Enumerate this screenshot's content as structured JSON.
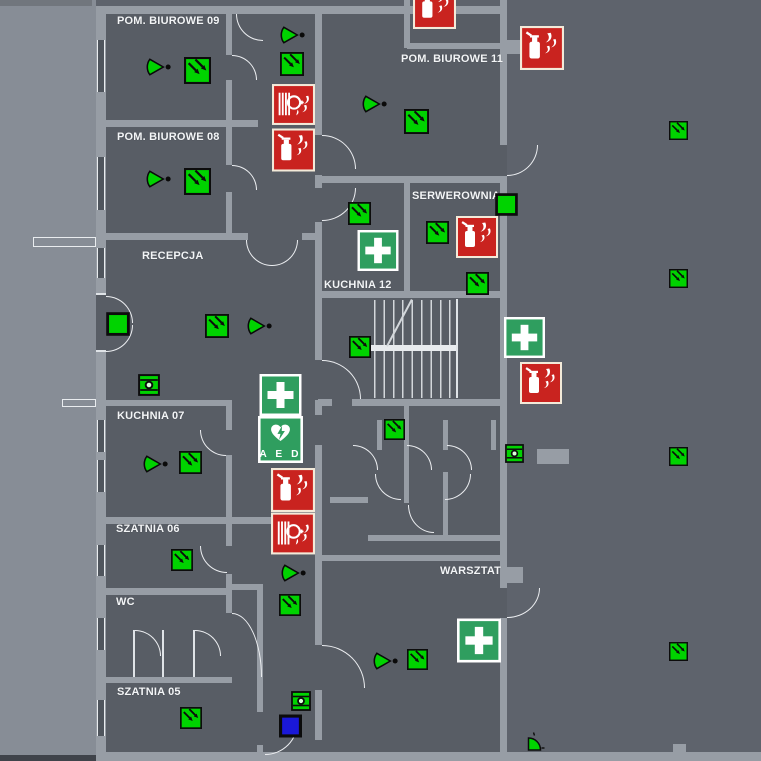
{
  "rooms": [
    {
      "label": "POM. BIUROWE 09"
    },
    {
      "label": "POM. BIUROWE 08"
    },
    {
      "label": "POM. BIUROWE 11"
    },
    {
      "label": "SERWEROWNIA"
    },
    {
      "label": "RECEPCJA"
    },
    {
      "label": "KUCHNIA 12"
    },
    {
      "label": "KUCHNIA 07"
    },
    {
      "label": "SZATNIA 06"
    },
    {
      "label": "WC"
    },
    {
      "label": "SZATNIA 05"
    },
    {
      "label": "WARSZTAT"
    }
  ],
  "aed_label": "A E D",
  "colors": {
    "evacuation_green": "#00D300",
    "sign_green": "#2F9E5F",
    "fire_red": "#C9231F",
    "sign_cream": "#F3EAD9",
    "equipment_blue": "#1A18D8",
    "background": "#5E636C",
    "wall": "#979DA5"
  },
  "icons": [
    {
      "t": "arrow",
      "x": 184,
      "y": 57,
      "w": 27,
      "h": 27
    },
    {
      "t": "arrow",
      "x": 184,
      "y": 168,
      "w": 27,
      "h": 27
    },
    {
      "t": "arrow",
      "x": 280,
      "y": 52,
      "w": 24,
      "h": 24
    },
    {
      "t": "arrow",
      "x": 404,
      "y": 109,
      "w": 25,
      "h": 25
    },
    {
      "t": "arrow",
      "x": 348,
      "y": 202,
      "w": 23,
      "h": 23
    },
    {
      "t": "arrow",
      "x": 426,
      "y": 221,
      "w": 23,
      "h": 23
    },
    {
      "t": "arrow",
      "x": 466,
      "y": 272,
      "w": 23,
      "h": 23
    },
    {
      "t": "arrow",
      "x": 205,
      "y": 314,
      "w": 24,
      "h": 24
    },
    {
      "t": "arrow",
      "x": 349,
      "y": 336,
      "w": 22,
      "h": 22
    },
    {
      "t": "arrow",
      "x": 179,
      "y": 451,
      "w": 23,
      "h": 23
    },
    {
      "t": "arrow",
      "x": 384,
      "y": 419,
      "w": 21,
      "h": 21
    },
    {
      "t": "arrow",
      "x": 171,
      "y": 549,
      "w": 22,
      "h": 22
    },
    {
      "t": "arrow",
      "x": 279,
      "y": 594,
      "w": 22,
      "h": 22
    },
    {
      "t": "arrow",
      "x": 180,
      "y": 707,
      "w": 22,
      "h": 22
    },
    {
      "t": "arrow",
      "x": 407,
      "y": 649,
      "w": 21,
      "h": 21
    },
    {
      "t": "arrow",
      "x": 669,
      "y": 121,
      "w": 19,
      "h": 19
    },
    {
      "t": "arrow",
      "x": 669,
      "y": 269,
      "w": 19,
      "h": 19
    },
    {
      "t": "arrow",
      "x": 669,
      "y": 447,
      "w": 19,
      "h": 19
    },
    {
      "t": "arrow",
      "x": 669,
      "y": 642,
      "w": 19,
      "h": 19
    },
    {
      "t": "cone",
      "x": 145,
      "y": 55,
      "w": 27,
      "h": 24
    },
    {
      "t": "cone",
      "x": 145,
      "y": 167,
      "w": 27,
      "h": 24
    },
    {
      "t": "cone",
      "x": 279,
      "y": 23,
      "w": 27,
      "h": 24
    },
    {
      "t": "cone",
      "x": 361,
      "y": 92,
      "w": 27,
      "h": 24
    },
    {
      "t": "cone",
      "x": 246,
      "y": 314,
      "w": 27,
      "h": 24
    },
    {
      "t": "cone",
      "x": 142,
      "y": 452,
      "w": 27,
      "h": 24
    },
    {
      "t": "cone",
      "x": 280,
      "y": 561,
      "w": 27,
      "h": 24
    },
    {
      "t": "cone",
      "x": 372,
      "y": 649,
      "w": 27,
      "h": 24
    },
    {
      "t": "firstaid",
      "x": 357,
      "y": 230,
      "w": 42,
      "h": 41
    },
    {
      "t": "firstaid",
      "x": 504,
      "y": 317,
      "w": 41,
      "h": 41
    },
    {
      "t": "firstaid",
      "x": 258,
      "y": 374,
      "w": 45,
      "h": 42
    },
    {
      "t": "firstaid",
      "x": 457,
      "y": 618,
      "w": 44,
      "h": 45
    },
    {
      "t": "aed",
      "x": 258,
      "y": 416,
      "w": 45,
      "h": 47
    },
    {
      "t": "ext",
      "x": 413,
      "y": -14,
      "w": 43,
      "h": 43
    },
    {
      "t": "ext",
      "x": 520,
      "y": 26,
      "w": 44,
      "h": 44
    },
    {
      "t": "ext",
      "x": 272,
      "y": 128,
      "w": 43,
      "h": 44
    },
    {
      "t": "ext",
      "x": 456,
      "y": 215,
      "w": 42,
      "h": 44
    },
    {
      "t": "ext",
      "x": 520,
      "y": 362,
      "w": 42,
      "h": 42
    },
    {
      "t": "ext",
      "x": 271,
      "y": 468,
      "w": 44,
      "h": 44
    },
    {
      "t": "hose",
      "x": 272,
      "y": 84,
      "w": 43,
      "h": 41
    },
    {
      "t": "hose",
      "x": 271,
      "y": 512,
      "w": 44,
      "h": 43
    },
    {
      "t": "device",
      "x": 138,
      "y": 374,
      "w": 22,
      "h": 22
    },
    {
      "t": "device",
      "x": 504,
      "y": 444,
      "w": 21,
      "h": 19
    },
    {
      "t": "device",
      "x": 291,
      "y": 691,
      "w": 20,
      "h": 20
    },
    {
      "t": "square",
      "x": 106,
      "y": 311,
      "w": 24,
      "h": 26
    },
    {
      "t": "square",
      "x": 495,
      "y": 193,
      "w": 23,
      "h": 23
    },
    {
      "t": "blue",
      "x": 279,
      "y": 714,
      "w": 23,
      "h": 24
    },
    {
      "t": "wedge",
      "x": 525,
      "y": 731,
      "w": 20,
      "h": 22
    }
  ]
}
